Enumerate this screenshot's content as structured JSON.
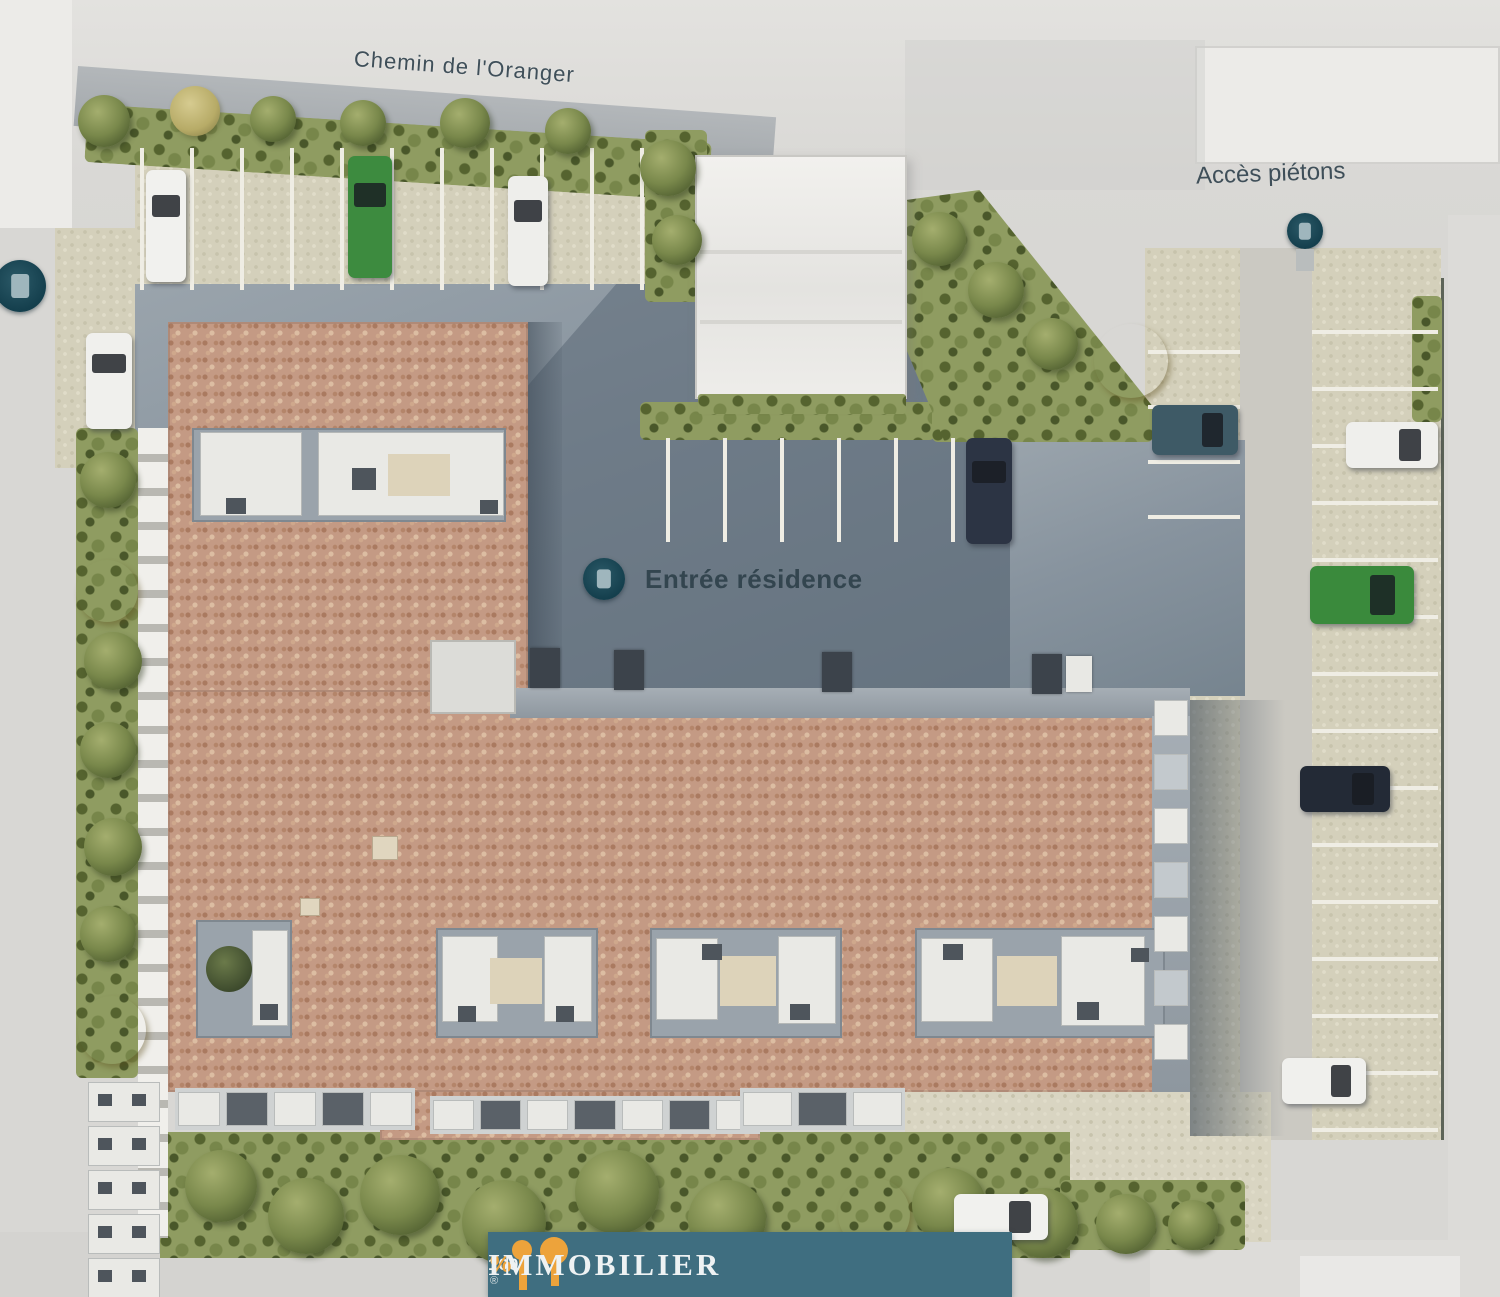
{
  "labels": {
    "street": "Chemin de l'Oranger",
    "pedestrian_access": "Accès piétons",
    "residence_entrance": "Entrée résidence"
  },
  "logo": {
    "prefix": "100",
    "percent": "%",
    "name": "IMMOBILIER",
    "reg": "®"
  },
  "colors": {
    "banner_teal": "#3f6e80",
    "logo_orange": "#eda33b",
    "marker_teal": "#143f4d",
    "roof_terracotta": "#c49a84",
    "asphalt": "#87939e",
    "hedge_green": "#8f9c61",
    "paving_beige": "#d4d0bb"
  },
  "plan": {
    "markers": [
      {
        "name": "site-entrance-marker-left",
        "x": -6,
        "y": 260,
        "d": 52
      },
      {
        "name": "pedestrian-access-marker",
        "x": 1287,
        "y": 213,
        "d": 36
      },
      {
        "name": "residence-entrance-marker",
        "x": 583,
        "y": 558,
        "d": 42
      }
    ],
    "cars": [
      {
        "name": "car-white-top-1",
        "x": 146,
        "y": 170,
        "w": 40,
        "h": 112,
        "color": "#f1f1ee",
        "dir": "v"
      },
      {
        "name": "car-green-top",
        "x": 348,
        "y": 156,
        "w": 44,
        "h": 122,
        "color": "#3d8b3f",
        "dir": "v"
      },
      {
        "name": "car-white-top-2",
        "x": 508,
        "y": 176,
        "w": 40,
        "h": 110,
        "color": "#eeeeeb",
        "dir": "v"
      },
      {
        "name": "car-white-left",
        "x": 86,
        "y": 333,
        "w": 46,
        "h": 96,
        "color": "#f0f0ed",
        "dir": "v"
      },
      {
        "name": "car-navy-center",
        "x": 966,
        "y": 438,
        "w": 46,
        "h": 106,
        "color": "#2c3444",
        "dir": "v"
      },
      {
        "name": "car-teal-right",
        "x": 1152,
        "y": 405,
        "w": 86,
        "h": 50,
        "color": "#3e5a66",
        "dir": "h"
      },
      {
        "name": "car-white-right-top",
        "x": 1346,
        "y": 422,
        "w": 92,
        "h": 46,
        "color": "#efefec",
        "dir": "h"
      },
      {
        "name": "car-green-right",
        "x": 1310,
        "y": 566,
        "w": 104,
        "h": 58,
        "color": "#3a8a3c",
        "dir": "h"
      },
      {
        "name": "car-dark-right",
        "x": 1300,
        "y": 766,
        "w": 90,
        "h": 46,
        "color": "#232a36",
        "dir": "h"
      },
      {
        "name": "car-white-right-bottom",
        "x": 1282,
        "y": 1058,
        "w": 84,
        "h": 46,
        "color": "#f0f0ed",
        "dir": "h"
      },
      {
        "name": "car-white-bottom",
        "x": 954,
        "y": 1194,
        "w": 94,
        "h": 46,
        "color": "#f1f1ee",
        "dir": "h"
      }
    ],
    "trees": [
      {
        "t": "g",
        "x": 78,
        "y": 95,
        "d": 52
      },
      {
        "t": "k",
        "x": 170,
        "y": 86,
        "d": 50
      },
      {
        "t": "g",
        "x": 250,
        "y": 96,
        "d": 46
      },
      {
        "t": "g",
        "x": 340,
        "y": 100,
        "d": 46
      },
      {
        "t": "g",
        "x": 440,
        "y": 98,
        "d": 50
      },
      {
        "t": "g",
        "x": 545,
        "y": 108,
        "d": 46
      },
      {
        "t": "g",
        "x": 640,
        "y": 140,
        "d": 56
      },
      {
        "t": "g",
        "x": 652,
        "y": 215,
        "d": 50
      },
      {
        "t": "g",
        "x": 912,
        "y": 212,
        "d": 54
      },
      {
        "t": "g",
        "x": 968,
        "y": 262,
        "d": 56
      },
      {
        "t": "g",
        "x": 1026,
        "y": 318,
        "d": 52
      },
      {
        "t": "y",
        "x": 1094,
        "y": 324,
        "d": 74
      },
      {
        "t": "y",
        "x": 76,
        "y": 560,
        "d": 62
      },
      {
        "t": "g",
        "x": 80,
        "y": 452,
        "d": 56
      },
      {
        "t": "g",
        "x": 84,
        "y": 632,
        "d": 58
      },
      {
        "t": "g",
        "x": 80,
        "y": 722,
        "d": 56
      },
      {
        "t": "g",
        "x": 84,
        "y": 818,
        "d": 58
      },
      {
        "t": "g",
        "x": 80,
        "y": 906,
        "d": 56
      },
      {
        "t": "y",
        "x": 78,
        "y": 996,
        "d": 68
      },
      {
        "t": "g",
        "x": 185,
        "y": 1150,
        "d": 72
      },
      {
        "t": "g",
        "x": 268,
        "y": 1178,
        "d": 76
      },
      {
        "t": "g",
        "x": 360,
        "y": 1155,
        "d": 80
      },
      {
        "t": "g",
        "x": 462,
        "y": 1180,
        "d": 84
      },
      {
        "t": "g",
        "x": 575,
        "y": 1150,
        "d": 84
      },
      {
        "t": "g",
        "x": 688,
        "y": 1180,
        "d": 78
      },
      {
        "t": "y",
        "x": 838,
        "y": 1178,
        "d": 72
      },
      {
        "t": "g",
        "x": 912,
        "y": 1168,
        "d": 74
      },
      {
        "t": "g",
        "x": 1008,
        "y": 1188,
        "d": 70
      },
      {
        "t": "g",
        "x": 1096,
        "y": 1194,
        "d": 60
      },
      {
        "t": "g",
        "x": 1168,
        "y": 1200,
        "d": 50
      }
    ],
    "stall_lines": {
      "top": {
        "x0": 140,
        "y": 148,
        "step": 50,
        "count": 11,
        "w": 4,
        "h": 142,
        "dir": "v"
      },
      "center": {
        "x0": 666,
        "y": 438,
        "step": 57,
        "count": 6,
        "w": 4,
        "h": 104,
        "dir": "v"
      },
      "right": {
        "x": 1312,
        "y0": 330,
        "step": 57,
        "count": 15,
        "w": 126,
        "h": 4,
        "dir": "h"
      },
      "rightInner": {
        "x": 1148,
        "y0": 350,
        "step": 55,
        "count": 4,
        "w": 92,
        "h": 4,
        "dir": "h"
      }
    },
    "garage_doors": [
      {
        "x": 530,
        "y": 648,
        "w": 30,
        "h": 40,
        "v": "d"
      },
      {
        "x": 614,
        "y": 650,
        "w": 30,
        "h": 40,
        "v": "d"
      },
      {
        "x": 822,
        "y": 652,
        "w": 30,
        "h": 40,
        "v": "d"
      },
      {
        "x": 1032,
        "y": 654,
        "w": 30,
        "h": 40,
        "v": "d"
      },
      {
        "x": 1066,
        "y": 656,
        "w": 26,
        "h": 36,
        "v": "w"
      }
    ],
    "vents": [
      {
        "x": 372,
        "y": 836,
        "w": 26,
        "h": 24
      },
      {
        "x": 300,
        "y": 898,
        "w": 20,
        "h": 18
      }
    ],
    "courtyards": [
      {
        "x": 192,
        "y": 428,
        "w": 314,
        "h": 94,
        "items": [
          {
            "t": "white",
            "x": 8,
            "y": 4,
            "w": 102,
            "h": 84
          },
          {
            "t": "dark",
            "x": 34,
            "y": 70,
            "w": 20,
            "h": 16
          },
          {
            "t": "white",
            "x": 126,
            "y": 4,
            "w": 186,
            "h": 84
          },
          {
            "t": "beige",
            "x": 196,
            "y": 26,
            "w": 62,
            "h": 42
          },
          {
            "t": "dark",
            "x": 160,
            "y": 40,
            "w": 24,
            "h": 22
          },
          {
            "t": "dark",
            "x": 288,
            "y": 72,
            "w": 18,
            "h": 14
          }
        ]
      },
      {
        "x": 196,
        "y": 920,
        "w": 96,
        "h": 118,
        "items": [
          {
            "t": "tree",
            "x": 10,
            "y": 26,
            "w": 46,
            "h": 46
          },
          {
            "t": "white",
            "x": 56,
            "y": 10,
            "w": 36,
            "h": 96
          },
          {
            "t": "dark",
            "x": 64,
            "y": 84,
            "w": 18,
            "h": 16
          }
        ]
      },
      {
        "x": 436,
        "y": 928,
        "w": 162,
        "h": 110,
        "items": [
          {
            "t": "white",
            "x": 6,
            "y": 8,
            "w": 56,
            "h": 86
          },
          {
            "t": "beige",
            "x": 54,
            "y": 30,
            "w": 52,
            "h": 46
          },
          {
            "t": "white",
            "x": 108,
            "y": 8,
            "w": 48,
            "h": 86
          },
          {
            "t": "dark",
            "x": 22,
            "y": 78,
            "w": 18,
            "h": 16
          },
          {
            "t": "dark",
            "x": 120,
            "y": 78,
            "w": 18,
            "h": 16
          }
        ]
      },
      {
        "x": 650,
        "y": 928,
        "w": 192,
        "h": 110,
        "items": [
          {
            "t": "white",
            "x": 6,
            "y": 10,
            "w": 62,
            "h": 82
          },
          {
            "t": "beige",
            "x": 70,
            "y": 28,
            "w": 56,
            "h": 50
          },
          {
            "t": "white",
            "x": 128,
            "y": 8,
            "w": 58,
            "h": 88
          },
          {
            "t": "dark",
            "x": 52,
            "y": 16,
            "w": 20,
            "h": 16
          },
          {
            "t": "dark",
            "x": 140,
            "y": 76,
            "w": 20,
            "h": 16
          }
        ]
      },
      {
        "x": 915,
        "y": 928,
        "w": 250,
        "h": 110,
        "items": [
          {
            "t": "white",
            "x": 6,
            "y": 10,
            "w": 72,
            "h": 84
          },
          {
            "t": "beige",
            "x": 82,
            "y": 28,
            "w": 60,
            "h": 50
          },
          {
            "t": "white",
            "x": 146,
            "y": 8,
            "w": 84,
            "h": 90
          },
          {
            "t": "dark",
            "x": 28,
            "y": 16,
            "w": 20,
            "h": 16
          },
          {
            "t": "dark",
            "x": 162,
            "y": 74,
            "w": 22,
            "h": 18
          },
          {
            "t": "dark",
            "x": 216,
            "y": 20,
            "w": 18,
            "h": 14
          }
        ]
      }
    ],
    "balcony_cells_right": {
      "x": 1154,
      "y0": 700,
      "step": 54,
      "count": 7,
      "w": 34,
      "h": 36
    },
    "terrace_cells_left": {
      "x": 88,
      "y0": 1082,
      "step": 44,
      "count": 5,
      "w": 72,
      "h": 40
    },
    "bottom_strips": [
      {
        "x": 175,
        "y": 1088,
        "w": 240,
        "h": 42,
        "cells": 5
      },
      {
        "x": 430,
        "y": 1096,
        "w": 330,
        "h": 38,
        "cells": 7
      },
      {
        "x": 740,
        "y": 1088,
        "w": 165,
        "h": 42,
        "cells": 3
      }
    ]
  }
}
